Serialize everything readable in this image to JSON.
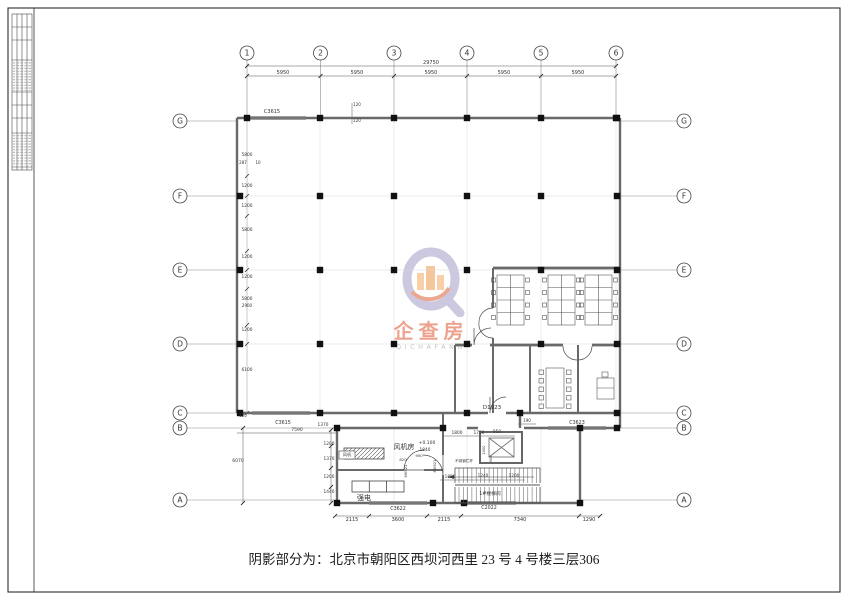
{
  "sheet": {
    "caption": "阴影部分为：北京市朝阳区西坝河西里 23 号 4 号楼三层306"
  },
  "watermark": {
    "cn": "企查房",
    "en": "QICHAFANG"
  },
  "bubbles": [
    {
      "n": "col-1",
      "t": "1",
      "x": 247,
      "y": 53
    },
    {
      "n": "col-2",
      "t": "2",
      "x": 320.5,
      "y": 53
    },
    {
      "n": "col-3",
      "t": "3",
      "x": 394,
      "y": 53
    },
    {
      "n": "col-4",
      "t": "4",
      "x": 467,
      "y": 53
    },
    {
      "n": "col-5",
      "t": "5",
      "x": 541,
      "y": 53
    },
    {
      "n": "col-6",
      "t": "6",
      "x": 616,
      "y": 53
    },
    {
      "n": "left-G",
      "t": "G",
      "x": 180,
      "y": 121
    },
    {
      "n": "left-F",
      "t": "F",
      "x": 180,
      "y": 196
    },
    {
      "n": "left-E",
      "t": "E",
      "x": 180,
      "y": 270
    },
    {
      "n": "left-D",
      "t": "D",
      "x": 180,
      "y": 344
    },
    {
      "n": "left-C",
      "t": "C",
      "x": 180,
      "y": 413
    },
    {
      "n": "left-B",
      "t": "B",
      "x": 180,
      "y": 428
    },
    {
      "n": "left-A",
      "t": "A",
      "x": 180,
      "y": 500
    },
    {
      "n": "right-G",
      "t": "G",
      "x": 684,
      "y": 121
    },
    {
      "n": "right-F",
      "t": "F",
      "x": 684,
      "y": 196
    },
    {
      "n": "right-E",
      "t": "E",
      "x": 684,
      "y": 270
    },
    {
      "n": "right-D",
      "t": "D",
      "x": 684,
      "y": 344
    },
    {
      "n": "right-C",
      "t": "C",
      "x": 684,
      "y": 413
    },
    {
      "n": "right-B",
      "t": "B",
      "x": 684,
      "y": 428
    },
    {
      "n": "right-A",
      "t": "A",
      "x": 684,
      "y": 500
    }
  ],
  "annotations": [
    {
      "n": "dim-total-top",
      "t": "29750",
      "x": 431,
      "y": 64,
      "s": 5
    },
    {
      "n": "dim-bay-1",
      "t": "5950",
      "x": 283,
      "y": 74,
      "s": 5
    },
    {
      "n": "dim-bay-2",
      "t": "5950",
      "x": 357,
      "y": 74,
      "s": 5
    },
    {
      "n": "dim-bay-3",
      "t": "5950",
      "x": 431,
      "y": 74,
      "s": 5
    },
    {
      "n": "dim-bay-4",
      "t": "5950",
      "x": 504,
      "y": 74,
      "s": 5
    },
    {
      "n": "dim-bay-5",
      "t": "5950",
      "x": 578,
      "y": 74,
      "s": 5
    },
    {
      "n": "win-c3615-top",
      "t": "C3615",
      "x": 272,
      "y": 113,
      "s": 5
    },
    {
      "n": "dim-120-a",
      "t": "120",
      "x": 357,
      "y": 106,
      "s": 4
    },
    {
      "n": "dim-120-b",
      "t": "120",
      "x": 357,
      "y": 122,
      "s": 4
    },
    {
      "n": "dim-5800-a",
      "t": "5800",
      "x": 247,
      "y": 156,
      "s": 4.3
    },
    {
      "n": "dim-287",
      "t": "287",
      "x": 243,
      "y": 164,
      "s": 4
    },
    {
      "n": "dim-10",
      "t": "10",
      "x": 258,
      "y": 164,
      "s": 4
    },
    {
      "n": "dim-1200-a",
      "t": "1200",
      "x": 247,
      "y": 187,
      "s": 4.3
    },
    {
      "n": "dim-1200-b",
      "t": "1200",
      "x": 247,
      "y": 207,
      "s": 4.3
    },
    {
      "n": "dim-5800-b",
      "t": "5800",
      "x": 247,
      "y": 231,
      "s": 4.3
    },
    {
      "n": "dim-1200-c",
      "t": "1200",
      "x": 247,
      "y": 258,
      "s": 4.3
    },
    {
      "n": "dim-1200-d",
      "t": "1200",
      "x": 247,
      "y": 278,
      "s": 4.3
    },
    {
      "n": "dim-5800-c",
      "t": "5800",
      "x": 247,
      "y": 300,
      "s": 4.3
    },
    {
      "n": "dim-2900",
      "t": "2900",
      "x": 247,
      "y": 307,
      "s": 4
    },
    {
      "n": "dim-1200-e",
      "t": "1200",
      "x": 247,
      "y": 331,
      "s": 4.3
    },
    {
      "n": "dim-6100",
      "t": "6100",
      "x": 247,
      "y": 371,
      "s": 4.3
    },
    {
      "n": "dim-120-c",
      "t": "120",
      "x": 243,
      "y": 417,
      "s": 4
    },
    {
      "n": "dim-6070",
      "t": "6070",
      "x": 238,
      "y": 462,
      "s": 4.5
    },
    {
      "n": "win-c3615-c",
      "t": "C3615",
      "x": 283,
      "y": 424,
      "s": 4.8
    },
    {
      "n": "dim-7590",
      "t": "7590",
      "x": 297,
      "y": 431,
      "s": 4.5
    },
    {
      "n": "dim-1370-top",
      "t": "1370",
      "x": 323,
      "y": 426,
      "s": 4.3
    },
    {
      "n": "door-d1923",
      "t": "D1923",
      "x": 492,
      "y": 409,
      "s": 5.5
    },
    {
      "n": "dim-190",
      "t": "190",
      "x": 527,
      "y": 422,
      "s": 4
    },
    {
      "n": "win-c3623",
      "t": "C3623",
      "x": 577,
      "y": 424,
      "s": 4.8
    },
    {
      "n": "dim-1200-f",
      "t": "1200",
      "x": 329,
      "y": 445,
      "s": 4.3
    },
    {
      "n": "dim-1370-b",
      "t": "1370",
      "x": 329,
      "y": 460,
      "s": 4.3
    },
    {
      "n": "dim-1200-g",
      "t": "1200",
      "x": 329,
      "y": 478,
      "s": 4.3
    },
    {
      "n": "dim-1440",
      "t": "1440",
      "x": 329,
      "y": 493,
      "s": 4.3
    },
    {
      "n": "room-fan",
      "t": "风机房",
      "x": 404,
      "y": 449,
      "s": 7
    },
    {
      "n": "label-fan-unit",
      "t": "风机",
      "x": 347,
      "y": 456,
      "s": 4.2
    },
    {
      "n": "room-power",
      "t": "强电",
      "x": 364,
      "y": 500,
      "s": 7
    },
    {
      "n": "elev-0100",
      "t": "+0.100",
      "x": 427,
      "y": 444,
      "s": 4.5
    },
    {
      "n": "elev-1840",
      "t": "1840",
      "x": 425,
      "y": 451,
      "s": 4.3
    },
    {
      "n": "door-m0921-a",
      "t": "M0921",
      "x": 407,
      "y": 471,
      "s": 3.8,
      "r": -90
    },
    {
      "n": "door-m0921-b",
      "t": "M0921",
      "x": 436,
      "y": 466,
      "s": 3.8,
      "r": -90
    },
    {
      "n": "dim-900",
      "t": "900",
      "x": 419,
      "y": 457,
      "s": 3.8
    },
    {
      "n": "dim-820",
      "t": "820",
      "x": 403,
      "y": 461,
      "s": 3.8
    },
    {
      "n": "label-handrail",
      "t": "不锈钢栏杆",
      "x": 464,
      "y": 462,
      "s": 3.6
    },
    {
      "n": "dim-1800",
      "t": "1800",
      "x": 457,
      "y": 434,
      "s": 4.3
    },
    {
      "n": "dim-1750",
      "t": "1750",
      "x": 479,
      "y": 434,
      "s": 4.3
    },
    {
      "n": "dim-950",
      "t": "950",
      "x": 497,
      "y": 433,
      "s": 4.3
    },
    {
      "n": "dim-1890",
      "t": "1890",
      "x": 450,
      "y": 478,
      "s": 4.2
    },
    {
      "n": "dim-1240",
      "t": "1240",
      "x": 483,
      "y": 477,
      "s": 4.2
    },
    {
      "n": "dim-1200-h",
      "t": "1200",
      "x": 514,
      "y": 477,
      "s": 4.2
    },
    {
      "n": "room-stair",
      "t": "1#楼梯间",
      "x": 490,
      "y": 495,
      "s": 4.8
    },
    {
      "n": "dim-1000-elev",
      "t": "1000",
      "x": 485,
      "y": 450,
      "s": 3.6,
      "r": -90
    },
    {
      "n": "dim-900-elev",
      "t": "900",
      "x": 492,
      "y": 459,
      "s": 3.6,
      "r": -90
    },
    {
      "n": "win-c3622",
      "t": "C3622",
      "x": 398,
      "y": 510,
      "s": 4.8
    },
    {
      "n": "win-c2022",
      "t": "C2022",
      "x": 489,
      "y": 509,
      "s": 4.8
    },
    {
      "n": "dim-2115-a",
      "t": "2115",
      "x": 352,
      "y": 521,
      "s": 5
    },
    {
      "n": "dim-3600",
      "t": "3600",
      "x": 398,
      "y": 521,
      "s": 5
    },
    {
      "n": "dim-2115-b",
      "t": "2115",
      "x": 444,
      "y": 521,
      "s": 5
    },
    {
      "n": "dim-7340",
      "t": "7340",
      "x": 520,
      "y": 521,
      "s": 5
    },
    {
      "n": "dim-1290",
      "t": "1290",
      "x": 589,
      "y": 521,
      "s": 5
    }
  ]
}
